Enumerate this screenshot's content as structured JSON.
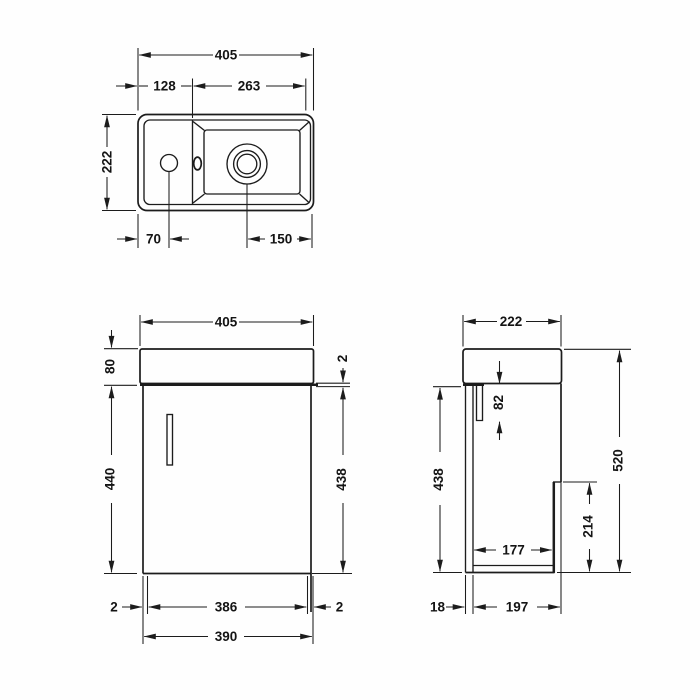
{
  "plan_view": {
    "overall_width": "405",
    "deck_width": "128",
    "bowl_width": "263",
    "overall_depth": "222",
    "tap_hole_offset": "70",
    "waste_offset": "150"
  },
  "front_view": {
    "overall_width": "405",
    "basin_height": "80",
    "cabinet_height": "440",
    "door_top_gap": "2",
    "door_height": "438",
    "door_gap_left": "2",
    "door_width": "386",
    "door_gap_right": "2",
    "cabinet_width": "390"
  },
  "side_view": {
    "overall_depth": "222",
    "bracket_recess_depth": "82",
    "back_panel_height": "438",
    "overall_height": "520",
    "service_recess_height": "214",
    "internal_depth": "177",
    "door_thickness": "18",
    "cabinet_depth": "197"
  }
}
